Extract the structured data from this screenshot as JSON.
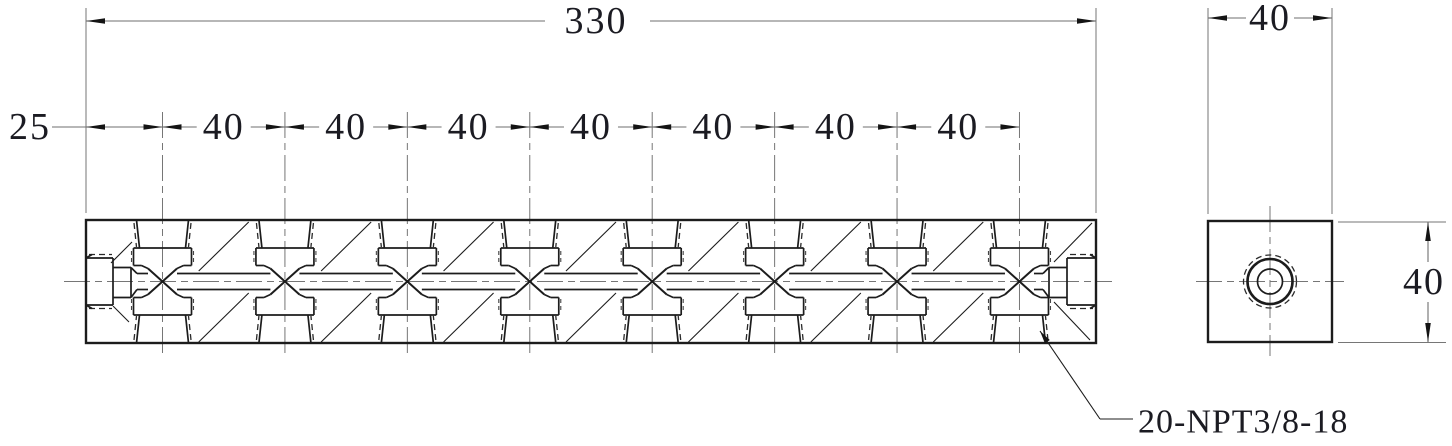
{
  "drawing": {
    "background": "#ffffff",
    "line_color": "#1c1c1c",
    "thin_line_color": "#767676",
    "text_color": "#1b1b22"
  },
  "front_view": {
    "overall_length": "330",
    "first_port_offset": "25",
    "port_pitches": [
      "40",
      "40",
      "40",
      "40",
      "40",
      "40",
      "40"
    ],
    "thread_callout": "20-NPT3/8-18"
  },
  "end_view": {
    "width": "40",
    "height": "40"
  }
}
